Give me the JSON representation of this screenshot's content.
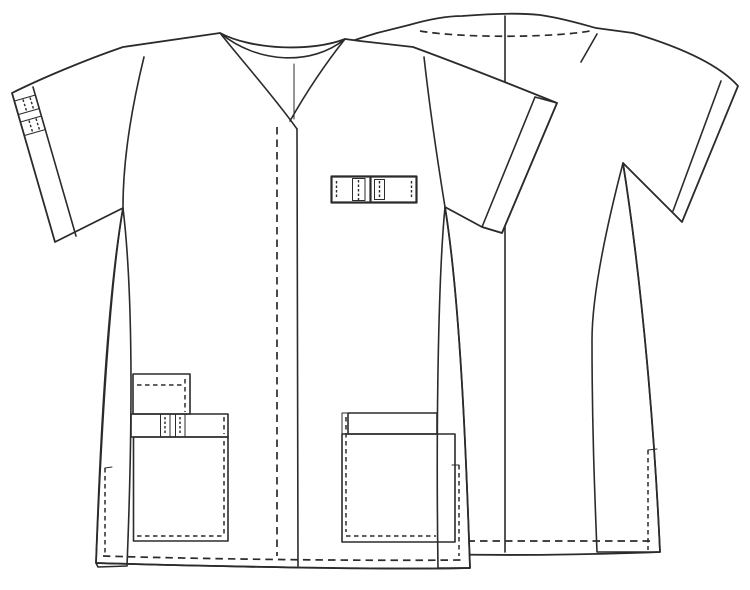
{
  "figure": {
    "kind": "garment-technical-flat",
    "garment": "short-sleeve v-neck scrub tunic",
    "views": [
      "front-view",
      "back-view"
    ]
  },
  "colors": {
    "teal": "#3dbe8e",
    "pale": "#ddecd2",
    "line": "#2b2b2b",
    "fabric": "#ffffff",
    "background": "#ffffff"
  },
  "front_view": {
    "parts": [
      "crossover-v-neckline",
      "back-neck-band",
      "center-front-placket-solid-edge",
      "center-front-topstitch-dashed",
      "left-sleeve-cuff-band-with-striped-trim",
      "right-sleeve-teal-cuff-band",
      "teal-left-side-panel",
      "pale-right-side-panel",
      "striped-chest-pen-tab",
      "small-upper-patch-pocket",
      "striped-pocket-trim-band",
      "large-lower-patch-pocket",
      "right-patch-pocket-with-teal-band",
      "hem-topstitch-dashed",
      "side-slit-topstitch-left",
      "side-slit-topstitch-right"
    ]
  },
  "back_view": {
    "parts": [
      "back-neck",
      "shoulder-seam-topstitch-dashed",
      "center-back-seam",
      "right-shoulder-notch",
      "sleeve-hem-double-line",
      "pale-left-side-panel",
      "pale-right-side-panel",
      "hem-topstitch-dashed",
      "side-slit-topstitch"
    ]
  }
}
